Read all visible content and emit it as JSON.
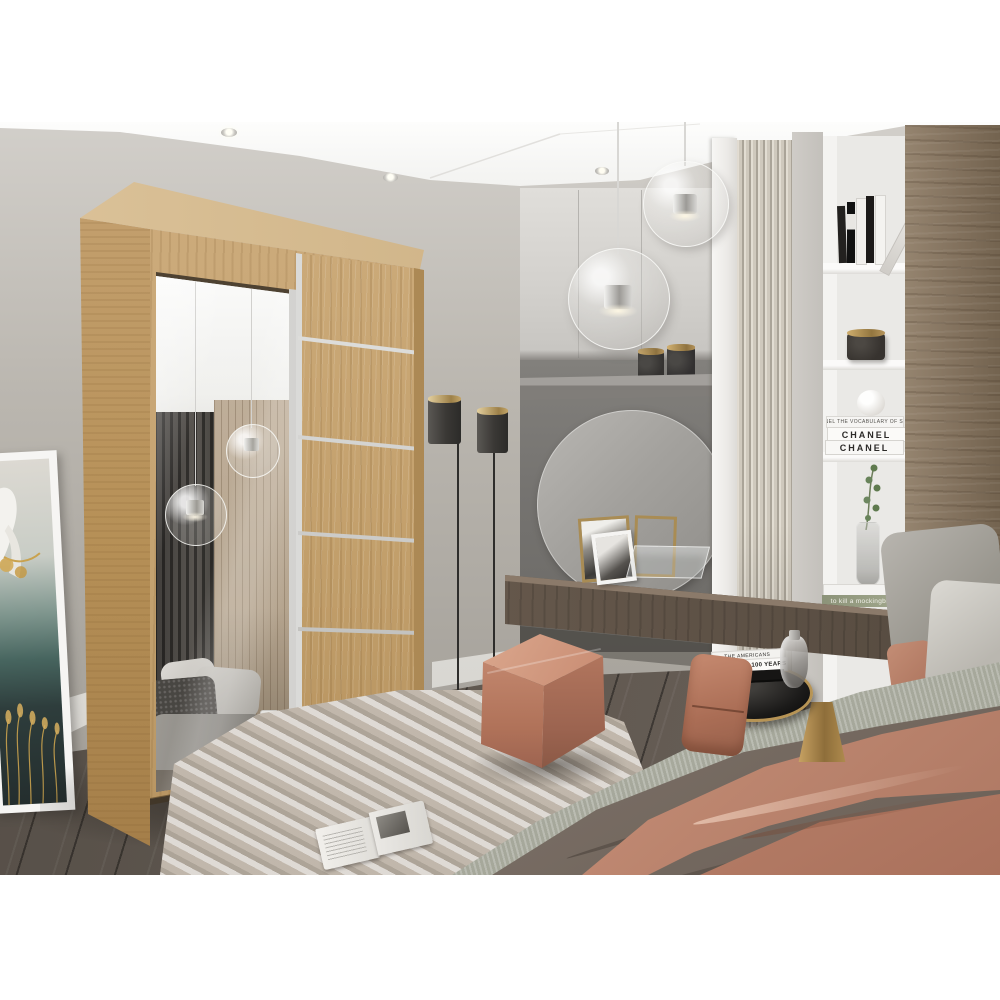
{
  "image": {
    "kind": "bedroom interior product render",
    "photo_top_px": 122,
    "photo_bottom_px": 875,
    "main_product": "two-door sliding wardrobe, oak finish, left mirror door, right oak door with chrome strips"
  },
  "texts": {
    "chanel_vocab": "CHANEL THE VOCABULARY OF STYLE",
    "chanel_1": "CHANEL",
    "chanel_2": "CHANEL",
    "mockingbird": "to kill a mockingbird",
    "vanity_fair": "VANITY FAIR 100 YEARS",
    "americans": "THE AMERICANS"
  },
  "palette": {
    "page_margin": "#ffffff",
    "ceiling": "#f4f4f2",
    "wall_grey": "#b3afa8",
    "oak_light": "#d6bb90",
    "oak": "#c8a877",
    "oak_dark": "#ab8756",
    "chrome": "#d9d9d6",
    "floor_dark": "#574f48",
    "rug_greige": "#c2b9ae",
    "pouf_salmon": "#c2826e",
    "throw_salmon": "#d4a089",
    "blanket_taupe": "#857970",
    "linen_sage": "#b8baad",
    "slat_cream": "#d6d0c4",
    "niche_grey": "#767370",
    "vanity_wood": "#665a4f",
    "panel_walnut": "#84735f",
    "shelf_white": "#f3f2f0",
    "brass_gold": "#b8995c",
    "lamp_shade": "#3c3a37"
  },
  "objects": [
    "glass globe pendant lights (2)",
    "recessed ceiling spotlights",
    "oak sliding wardrobe with mirror door",
    "mirror reflection: curtain, slat wall, bed, pendant globes, rug, magazine",
    "framed crane artwork leaning on wall",
    "double-head black floor lamp with brass base",
    "grey wall cabinets above vanity niche",
    "round mirror in dark vanity niche",
    "floating walnut vanity shelf with photo frames and glass box",
    "canisters with gold lids (2)",
    "cream slatted wall panel",
    "white shelving unit with books, candle, sphere, CHANEL books, vase with sprig",
    "walnut wall panel",
    "bed with sage linen, taupe blanket, salmon throw, grey pillows",
    "round side table with black glass top and gold base, books and smoked glass vase",
    "salmon cube pouf and salmon floor cushion",
    "greige marbled rug with open magazine",
    "dark grey plank floor"
  ]
}
